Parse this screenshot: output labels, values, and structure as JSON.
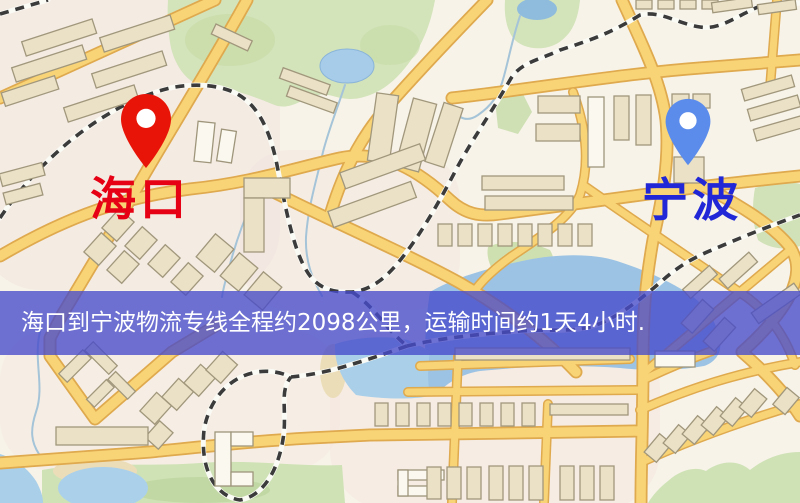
{
  "map": {
    "markers": {
      "origin": {
        "label": "海口",
        "label_color": "#e60114",
        "pin_color": "#e91408",
        "pin_icon": "red-map-pin"
      },
      "destination": {
        "label": "宁波",
        "label_color": "#2127d6",
        "pin_color": "#5b8cec",
        "pin_icon": "blue-map-pin"
      }
    },
    "style_colors": {
      "land": "#f7f3e8",
      "water": "#a9cfe9",
      "park": "#d3e3ba",
      "road": "#f8d476",
      "railway": "#3b3b3b",
      "building": "#eae1c6"
    }
  },
  "banner": {
    "text": "海口到宁波物流专线全程约2098公里，运输时间约1天4小时.",
    "background_color": "rgba(70,74,203,0.78)",
    "text_color": "#ffffff"
  }
}
